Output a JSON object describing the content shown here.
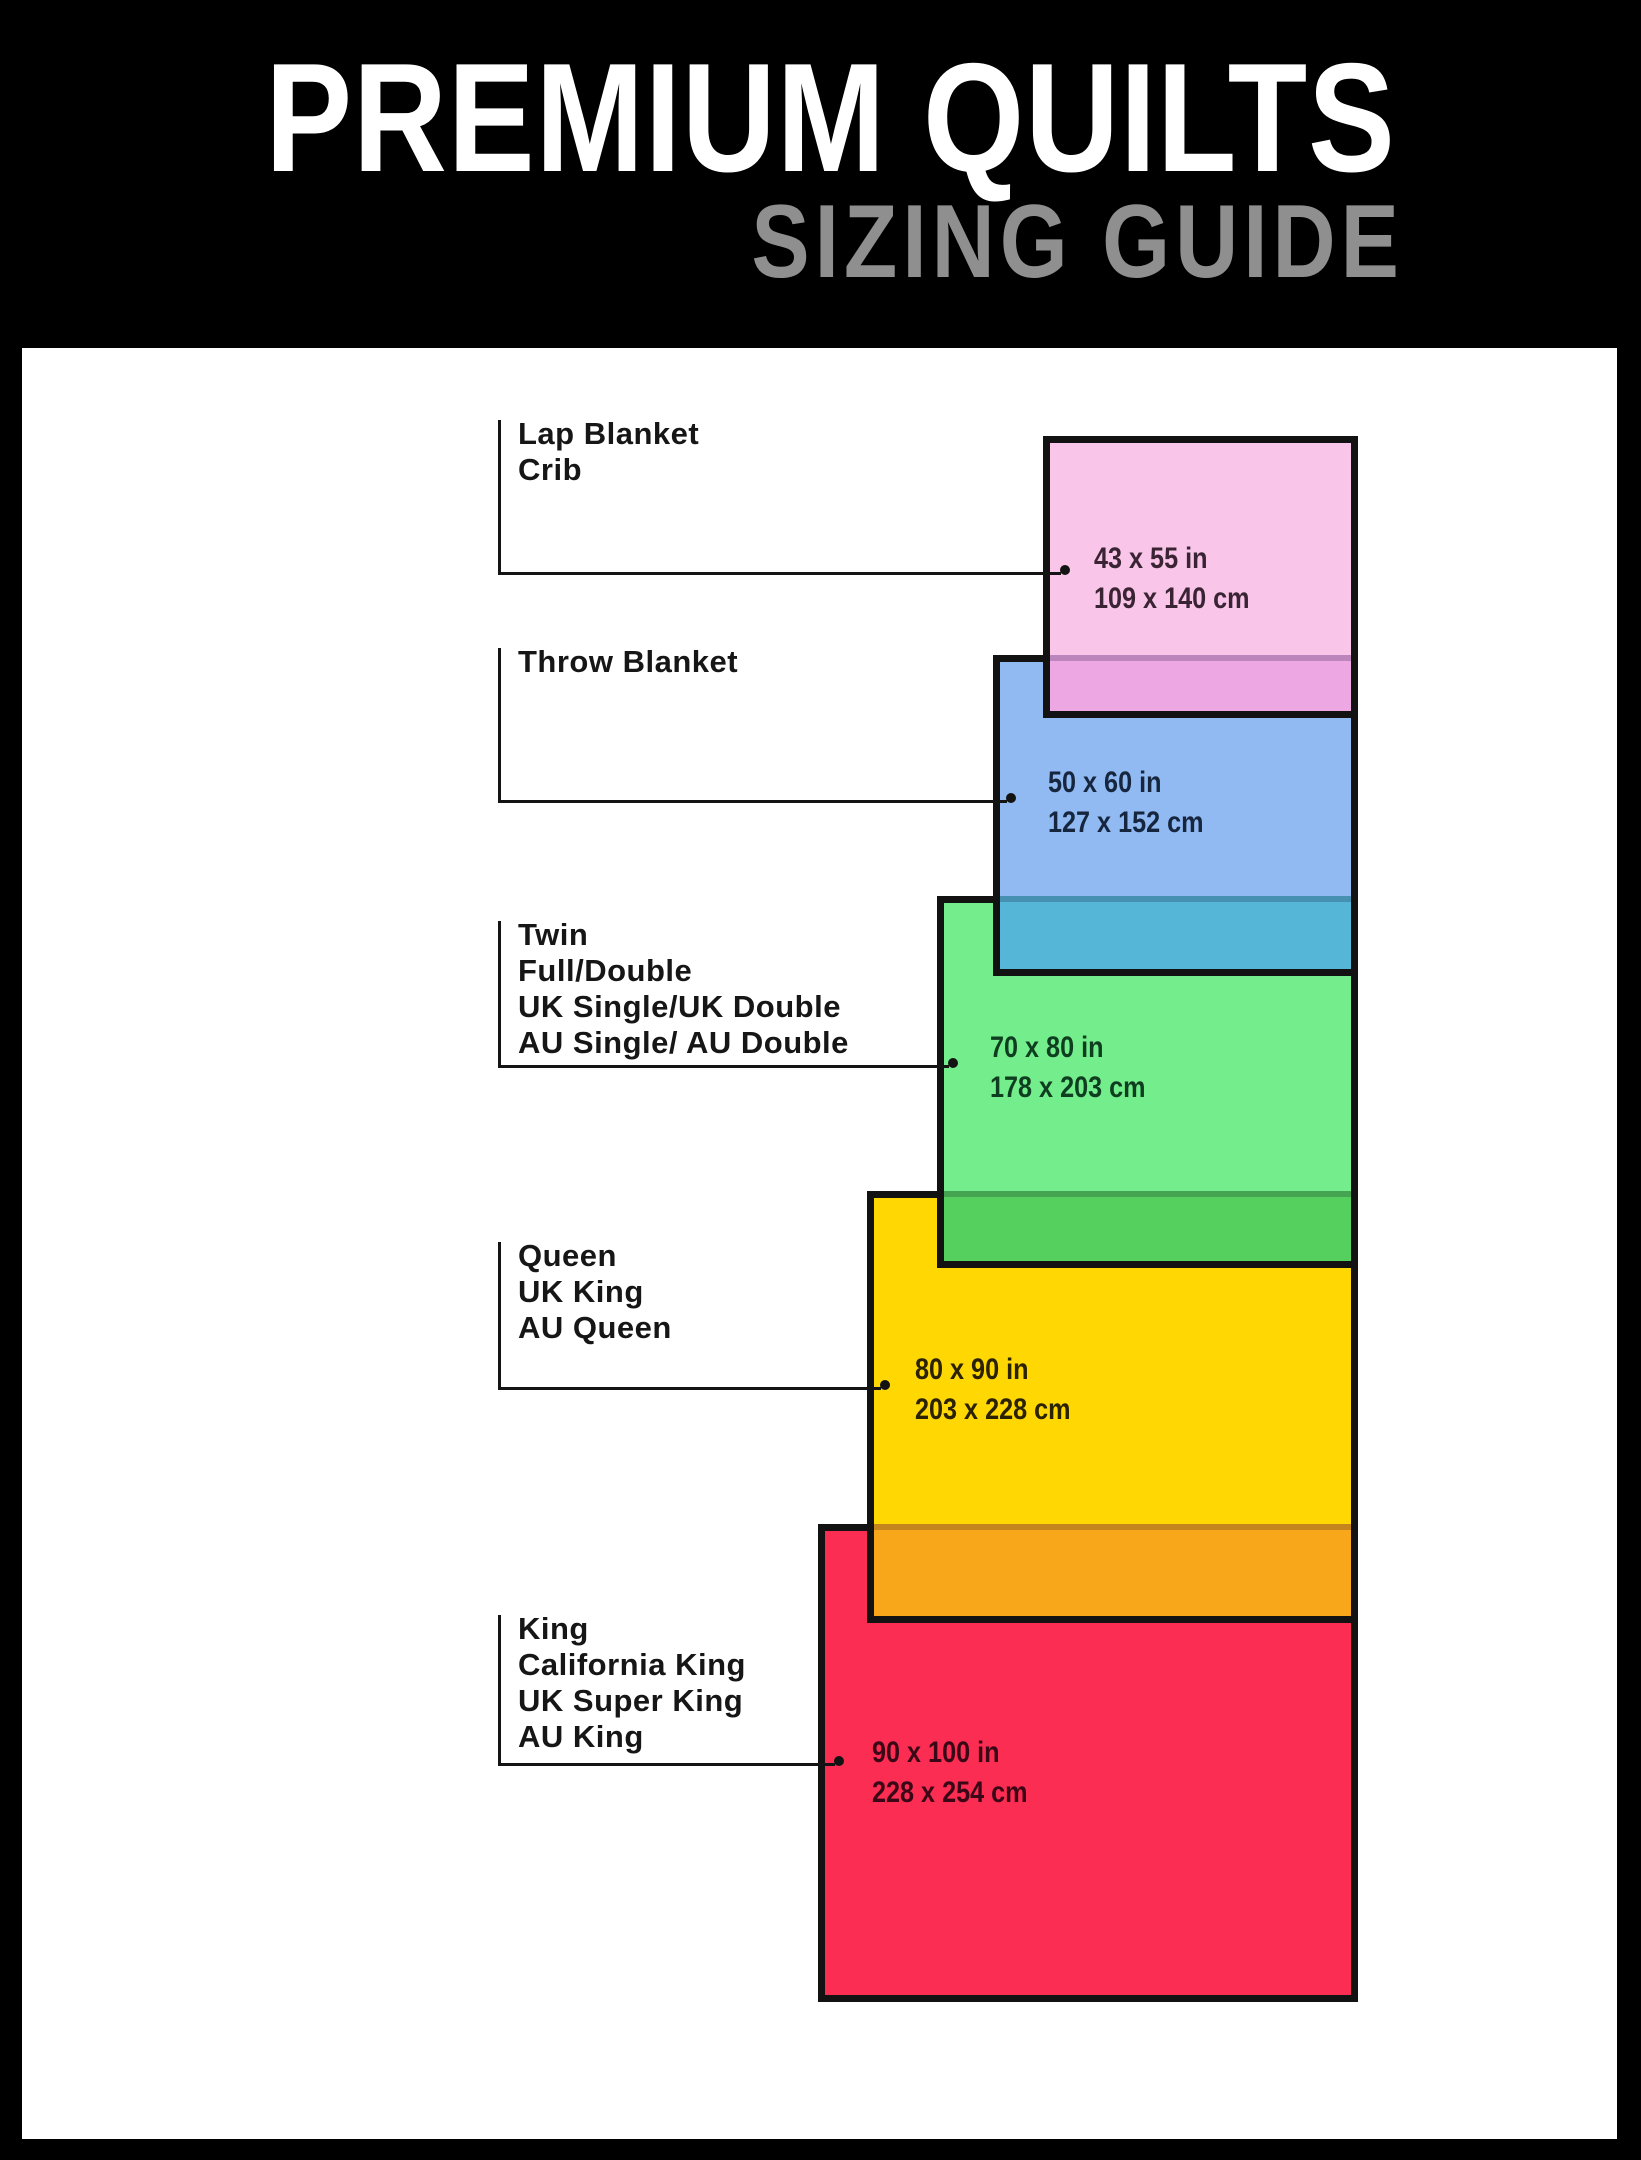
{
  "header": {
    "title": "PREMIUM QUILTS",
    "subtitle": "SIZING GUIDE",
    "title_color": "#ffffff",
    "subtitle_color": "#8f8f8f",
    "bg": "#000000"
  },
  "panel_bg": "#ffffff",
  "stroke": {
    "rect_border": "#121212",
    "leader_line": "#141414",
    "label_color": "#161616"
  },
  "sizes": [
    {
      "id": "lap-blanket-crib",
      "labels": [
        "Lap Blanket",
        "Crib"
      ],
      "inches": "43 x 55 in",
      "cm": "109 x 140 cm",
      "fill": "#f9c6e9",
      "overlap_fill": "#eda7e3",
      "text_color": "#3a2433"
    },
    {
      "id": "throw-blanket",
      "labels": [
        "Throw Blanket"
      ],
      "inches": "50 x 60 in",
      "cm": "127 x 152 cm",
      "fill": "#91baf2",
      "overlap_fill": "#56b6d8",
      "text_color": "#16263e"
    },
    {
      "id": "twin-full-double",
      "labels": [
        "Twin",
        "Full/Double",
        "UK Single/UK Double",
        "AU Single/ AU Double"
      ],
      "inches": "70 x 80 in",
      "cm": "178 x 203 cm",
      "fill": "#74ee8c",
      "overlap_fill": "#55cf5d",
      "text_color": "#0e3d20"
    },
    {
      "id": "queen",
      "labels": [
        "Queen",
        "UK King",
        "AU Queen"
      ],
      "inches": "80 x 90 in",
      "cm": "203 x 228 cm",
      "fill": "#ffd703",
      "overlap_fill": "#f8a71b",
      "text_color": "#2a2200"
    },
    {
      "id": "king",
      "labels": [
        "King",
        "California King",
        "UK Super King",
        "AU King"
      ],
      "inches": "90 x 100 in",
      "cm": "228 x 254 cm",
      "fill": "#fb2d53",
      "text_color": "#3b0716"
    }
  ]
}
